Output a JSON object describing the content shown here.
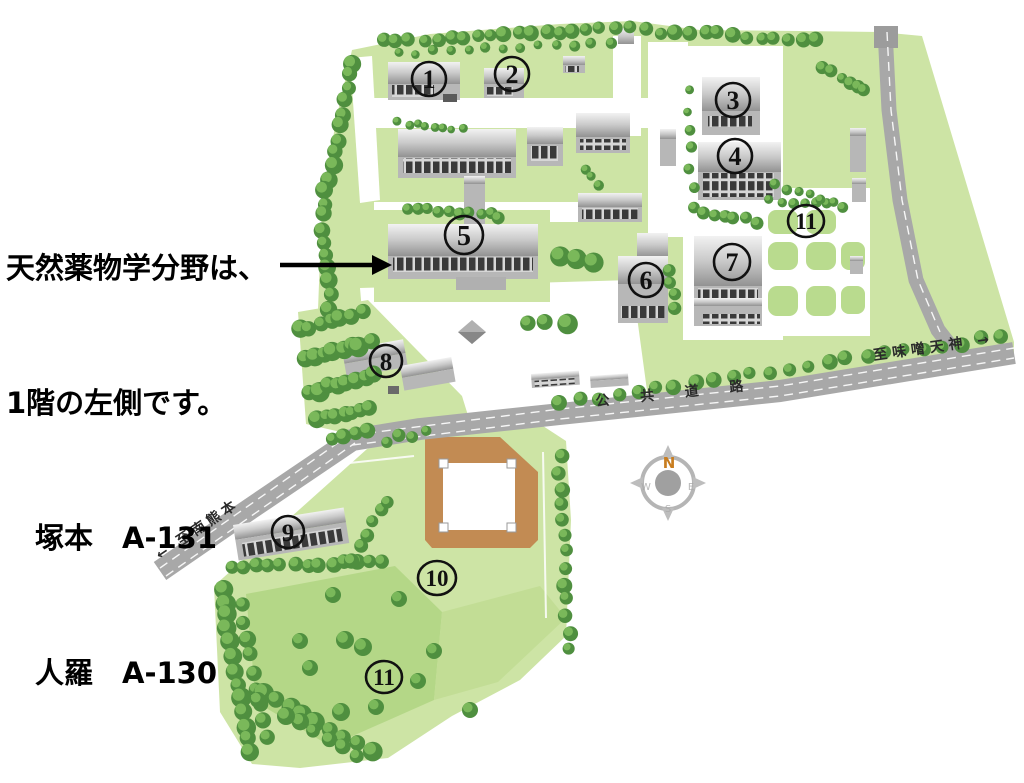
{
  "annotation": {
    "line1": "天然薬物学分野は、",
    "line2": "1階の左側です。",
    "line3": "　塚本　A-131",
    "line4": "　人羅　A-130"
  },
  "roads": {
    "public_road_label": "公 共 道 路",
    "to_misotenjin": "至味噌天神 →",
    "to_minami_kumamoto": "← 至南熊本"
  },
  "compass": {
    "north": "N",
    "west": "W",
    "east": "E",
    "south": "S"
  },
  "markers": {
    "b1": "1",
    "b2": "2",
    "b3": "3",
    "b4": "4",
    "b5": "5",
    "b6": "6",
    "b7": "7",
    "b8": "8",
    "b9": "9",
    "b10": "10",
    "b11_north": "11",
    "b11_south": "11"
  },
  "colors": {
    "campus_green": "#cde4a5",
    "field_green_dark": "#b4d787",
    "field_green_mid": "#c2dd95",
    "tree_green": "#4f8f3f",
    "road_gray": "#a8a8a8",
    "court_brown": "#c28b53",
    "building_gray": "#b7b7b7",
    "compass_orange": "#c87d20",
    "text_black": "#000000"
  }
}
